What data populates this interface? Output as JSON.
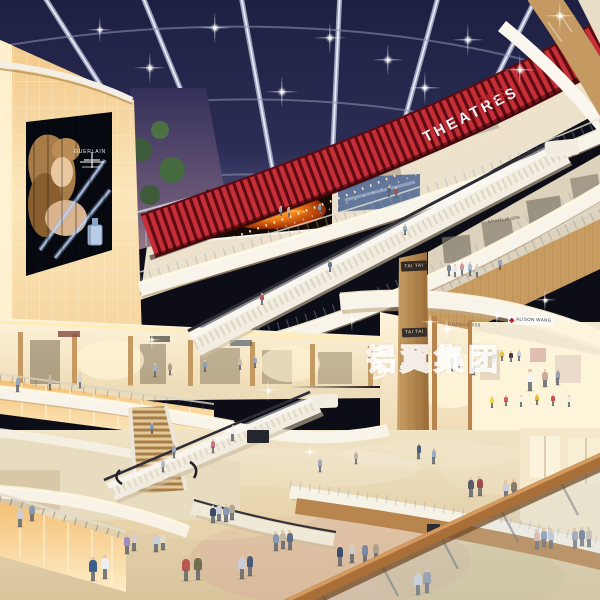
{
  "theatre": {
    "sign": "THEATRES",
    "sign_partial": "RES"
  },
  "stores": {
    "tai_tai": "TAI TAI",
    "charlie": "CHARLIE 888",
    "alison": "ALISON WANG"
  },
  "billboard": {
    "brand": "GUERLAIN"
  },
  "watermark": {
    "text": "铝翼集团"
  },
  "colors": {
    "ceiling_navy": "#23254a",
    "theatre_red": "#c62f38",
    "theatre_red_dark": "#5e0b11",
    "wood": "#c49a62",
    "fascia_white": "#f8f4ea",
    "glow_amber": "#f6cd8a",
    "floor_beige": "#e6d4ae",
    "handrail_wood": "#a86f38"
  },
  "figures": [
    [
      449,
      276,
      13,
      "#7b8aa0"
    ],
    [
      455,
      277,
      13,
      "#e8e8ec"
    ],
    [
      462,
      275,
      13,
      "#c89aa4"
    ],
    [
      470,
      276,
      14,
      "#a8bcd4"
    ],
    [
      477,
      277,
      13,
      "#d6cec0"
    ],
    [
      500,
      270,
      12,
      "#98a4b4"
    ],
    [
      389,
      197,
      11,
      "#5b6478"
    ],
    [
      396,
      198,
      11,
      "#94564e"
    ],
    [
      281,
      216,
      10,
      "#9aa6b8"
    ],
    [
      289,
      217,
      10,
      "#b8a89a"
    ],
    [
      320,
      214,
      10,
      "#8494a8"
    ],
    [
      262,
      305,
      12,
      "#b05860"
    ],
    [
      330,
      272,
      12,
      "#6a7a92"
    ],
    [
      405,
      235,
      11,
      "#9ab0c4"
    ],
    [
      18,
      392,
      16,
      "#92a6c6"
    ],
    [
      50,
      390,
      15,
      "#c6b8a8"
    ],
    [
      80,
      388,
      15,
      "#d4d6de"
    ],
    [
      155,
      377,
      14,
      "#a4b2c6"
    ],
    [
      170,
      375,
      13,
      "#b89a8a"
    ],
    [
      205,
      372,
      12,
      "#8ea0b8"
    ],
    [
      240,
      370,
      12,
      "#c8beae"
    ],
    [
      255,
      368,
      12,
      "#9aa8bc"
    ],
    [
      233,
      441,
      16,
      "#f0eef4"
    ],
    [
      213,
      453,
      14,
      "#c8727e"
    ],
    [
      152,
      434,
      12,
      "#8a9ab2"
    ],
    [
      174,
      458,
      14,
      "#9aa4b8"
    ],
    [
      163,
      472,
      13,
      "#b4bcc8"
    ],
    [
      20,
      527,
      20,
      "#c9ced9"
    ],
    [
      32,
      521,
      18,
      "#8a9aac"
    ],
    [
      452,
      371,
      15,
      "#8a8a98"
    ],
    [
      459,
      369,
      14,
      "#c8ba9c"
    ],
    [
      474,
      375,
      16,
      "#eae6dc"
    ],
    [
      530,
      391,
      22,
      "#f4f4f0"
    ],
    [
      545,
      387,
      18,
      "#d0a89a"
    ],
    [
      558,
      385,
      16,
      "#9aa0ae"
    ],
    [
      494,
      363,
      11,
      "#2e2e36"
    ],
    [
      502,
      361,
      11,
      "#e6c63e"
    ],
    [
      511,
      362,
      11,
      "#3c3c48"
    ],
    [
      519,
      361,
      11,
      "#caccd6"
    ],
    [
      492,
      408,
      12,
      "#e8d84e"
    ],
    [
      506,
      406,
      11,
      "#de5a5a"
    ],
    [
      521,
      407,
      12,
      "#f4f4f4"
    ],
    [
      537,
      405,
      11,
      "#e8b832"
    ],
    [
      553,
      406,
      12,
      "#d05050"
    ],
    [
      569,
      407,
      12,
      "#ececf0"
    ],
    [
      537,
      549,
      20,
      "#d8bcac"
    ],
    [
      544,
      547,
      19,
      "#8a9aac"
    ],
    [
      551,
      548,
      20,
      "#c2cad4"
    ],
    [
      575,
      548,
      20,
      "#9aa4b4"
    ],
    [
      582,
      546,
      19,
      "#6a7a94"
    ],
    [
      589,
      547,
      20,
      "#c8beb2"
    ],
    [
      419,
      459,
      16,
      "#4a5a80"
    ],
    [
      434,
      464,
      16,
      "#9aaac2"
    ],
    [
      471,
      497,
      20,
      "#5a5a68"
    ],
    [
      480,
      496,
      20,
      "#a04a4a"
    ],
    [
      506,
      499,
      19,
      "#caced6"
    ],
    [
      514,
      498,
      19,
      "#8a7a68"
    ],
    [
      93,
      581,
      24,
      "#3c5c8c"
    ],
    [
      105,
      579,
      24,
      "#eceef2"
    ],
    [
      127,
      554,
      20,
      "#9a8cc2"
    ],
    [
      134,
      551,
      20,
      "#d8d0c4"
    ],
    [
      156,
      552,
      19,
      "#c8d0da"
    ],
    [
      163,
      550,
      18,
      "#e0d8c8"
    ],
    [
      186,
      581,
      26,
      "#b85a50"
    ],
    [
      198,
      580,
      26,
      "#72704e"
    ],
    [
      213,
      523,
      18,
      "#3a4a6a"
    ],
    [
      219,
      521,
      17,
      "#d0d0d8"
    ],
    [
      226,
      522,
      18,
      "#8a98b0"
    ],
    [
      232,
      520,
      17,
      "#b0a890"
    ],
    [
      242,
      579,
      24,
      "#c8cdd6"
    ],
    [
      250,
      576,
      23,
      "#4a5a78"
    ],
    [
      276,
      551,
      20,
      "#8a9ab0"
    ],
    [
      283,
      549,
      19,
      "#c8b8a0"
    ],
    [
      290,
      550,
      20,
      "#5a6a88"
    ],
    [
      340,
      566,
      22,
      "#3c4c6c"
    ],
    [
      352,
      563,
      21,
      "#d0ccc4"
    ],
    [
      365,
      564,
      22,
      "#7a88a2"
    ],
    [
      376,
      561,
      20,
      "#b0a28e"
    ],
    [
      418,
      595,
      24,
      "#c8d0dc"
    ],
    [
      427,
      593,
      24,
      "#8a98ac"
    ],
    [
      320,
      472,
      14,
      "#9aa8bc"
    ],
    [
      356,
      464,
      13,
      "#c0b4a4"
    ]
  ],
  "sparkles": [
    [
      150,
      68,
      5
    ],
    [
      215,
      28,
      5
    ],
    [
      282,
      92,
      5
    ],
    [
      330,
      38,
      5
    ],
    [
      388,
      60,
      5
    ],
    [
      425,
      88,
      5
    ],
    [
      468,
      40,
      5
    ],
    [
      520,
      70,
      5
    ],
    [
      560,
      16,
      5
    ],
    [
      100,
      30,
      4
    ],
    [
      352,
      320,
      3.5
    ],
    [
      447,
      329,
      3.5
    ],
    [
      497,
      315,
      3.5
    ],
    [
      545,
      300,
      3.5
    ],
    [
      268,
      390,
      3.5
    ],
    [
      152,
      340,
      3
    ],
    [
      310,
      452,
      3
    ],
    [
      430,
      322,
      3
    ]
  ]
}
